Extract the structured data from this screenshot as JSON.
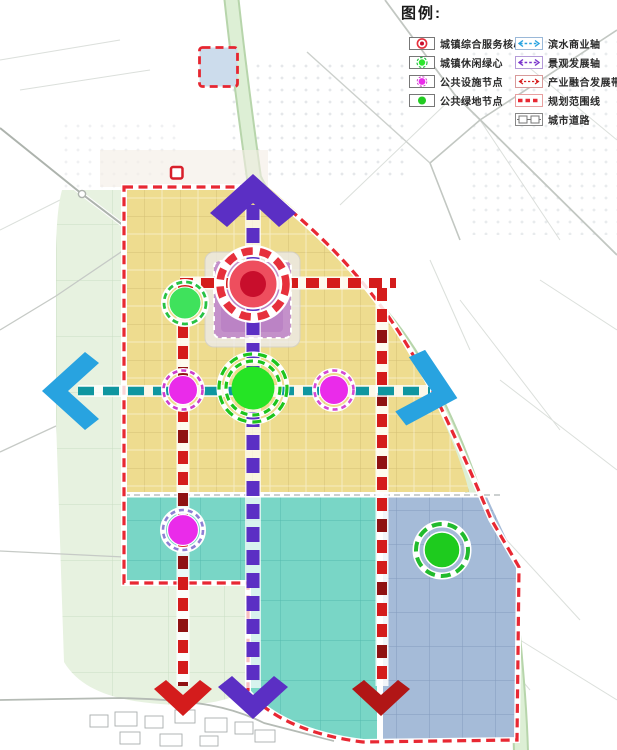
{
  "legend": {
    "title": "图例:",
    "column1": [
      {
        "label": "城镇综合服务核心",
        "icon": "core-node-icon",
        "color": "#e6303c"
      },
      {
        "label": "城镇休闲绿心",
        "icon": "leisure-green-icon",
        "color": "#2de62d"
      },
      {
        "label": "公共设施节点",
        "icon": "facility-node-icon",
        "color": "#ea2bea"
      },
      {
        "label": "公共绿地节点",
        "icon": "green-space-icon",
        "color": "#22cc22"
      }
    ],
    "column2": [
      {
        "label": "滨水商业轴",
        "icon": "waterfront-axis-icon",
        "color": "#28a3e0"
      },
      {
        "label": "景观发展轴",
        "icon": "landscape-axis-icon",
        "color": "#7a35cc"
      },
      {
        "label": "产业融合发展带",
        "icon": "industry-belt-icon",
        "color": "#d62020"
      },
      {
        "label": "规划范围线",
        "icon": "boundary-line-icon",
        "color": "#e82833"
      },
      {
        "label": "城市道路",
        "icon": "city-road-icon",
        "color": "#555555"
      }
    ]
  },
  "colors": {
    "urban_yellow": "#eedc8f",
    "industry_teal": "#79d6c6",
    "industry_blue": "#a5bbd8",
    "green_open": "#e7f2e0",
    "axis_waterfront": "#0f96a0",
    "axis_landscape": "#5b2fc4",
    "belt_industry": "#d41c1c",
    "boundary_red": "#e82833",
    "node_magenta": "#ea2bea",
    "node_green": "#25e425",
    "core_red": "#c80e2c",
    "arrow_blue": "#28a3e0"
  }
}
